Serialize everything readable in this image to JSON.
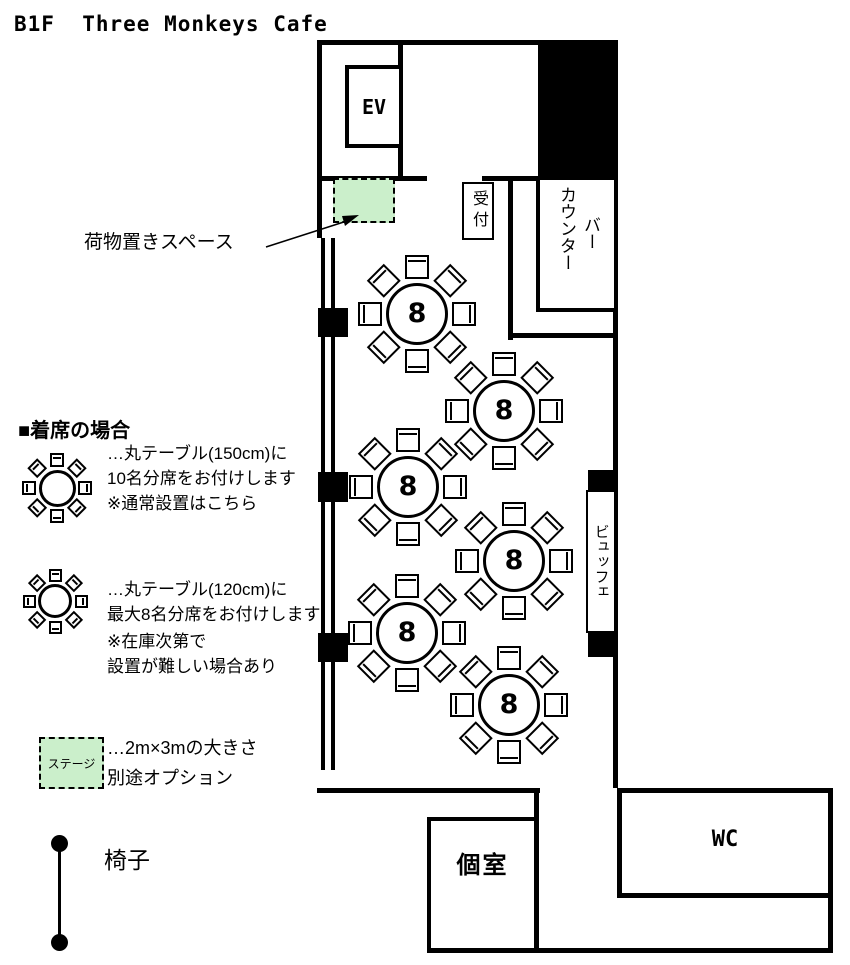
{
  "title": "B1F  Three Monkeys Cafe",
  "floorplan": {
    "rooms": {
      "elevator": "EV",
      "reception": "受付",
      "counter": "カウンター",
      "bar": "バー",
      "buffet": "ビュッフェ",
      "private_room": "個室",
      "wc": "WC"
    },
    "luggage_area_label": "荷物置きスペース",
    "tables": [
      {
        "x": 417,
        "y": 314,
        "seats": "8"
      },
      {
        "x": 504,
        "y": 411,
        "seats": "8"
      },
      {
        "x": 408,
        "y": 487,
        "seats": "8"
      },
      {
        "x": 514,
        "y": 561,
        "seats": "8"
      },
      {
        "x": 407,
        "y": 633,
        "seats": "8"
      },
      {
        "x": 509,
        "y": 705,
        "seats": "8"
      }
    ]
  },
  "legend": {
    "heading": "■着席の場合",
    "table_150": {
      "line1": "…丸テーブル(150cm)に",
      "line2": "10名分席をお付けします",
      "line3": "※通常設置はこちら"
    },
    "table_120": {
      "line1": "…丸テーブル(120cm)に",
      "line2": "最大8名分席をお付けします",
      "line3": "※在庫次第で",
      "line4": "設置が難しい場合あり"
    },
    "stage": {
      "box_label": "ステージ",
      "line1": "…2m×3mの大きさ",
      "line2": "別途オプション"
    },
    "chair_label": "椅子"
  },
  "colors": {
    "highlight_green": "#cbefcb",
    "wall": "#000000"
  }
}
